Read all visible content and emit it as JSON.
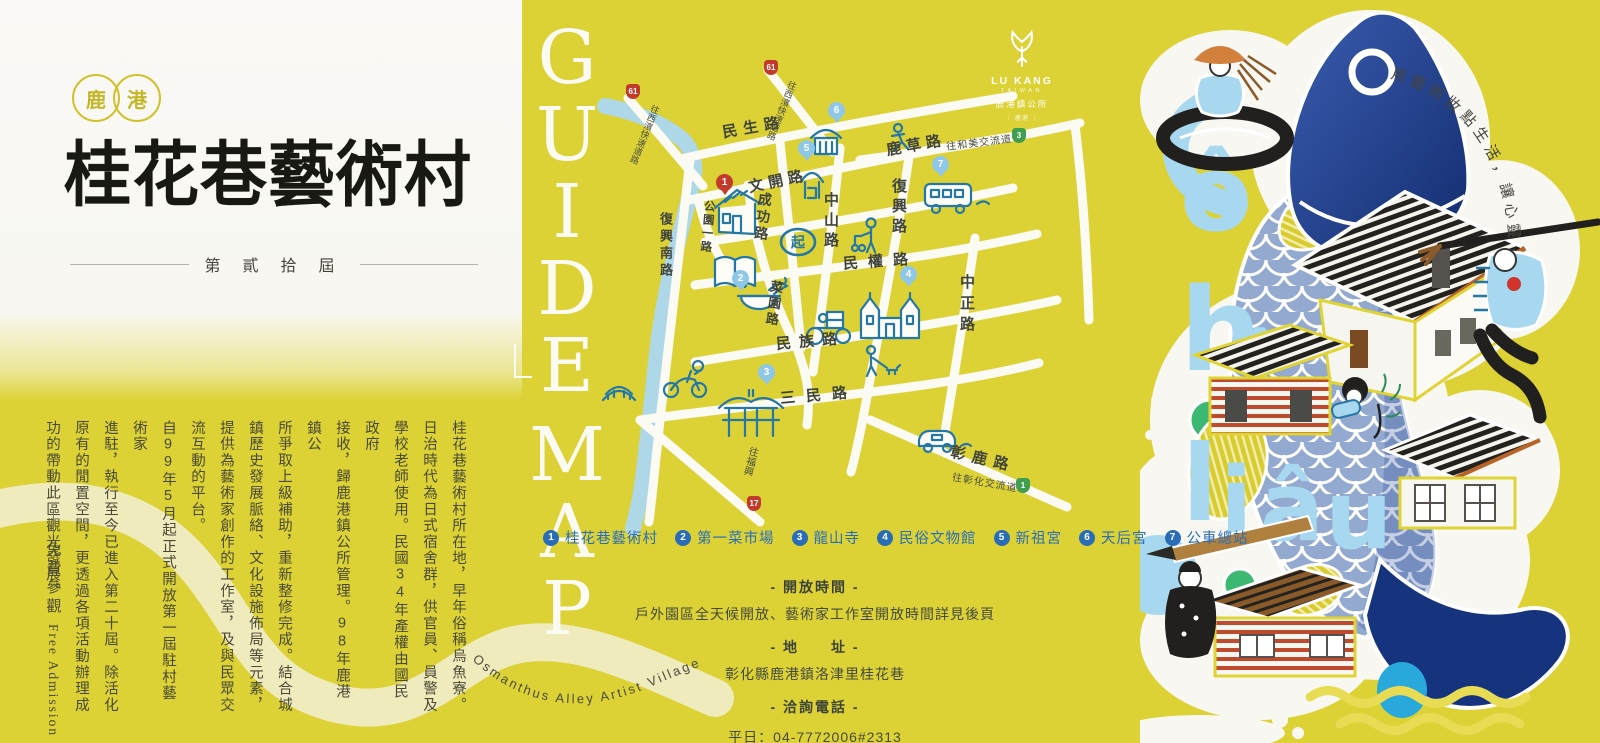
{
  "colors": {
    "bg_yellow": "#dcd235",
    "panel_white": "#f8f7f2",
    "ink_black": "#191914",
    "text_olive": "#4a4936",
    "map_doodle_blue": "#2577a6",
    "legend_blue": "#2a6db7",
    "river_blue": "#aed7e8",
    "fish_navy": "#16337e",
    "light_blue": "#a8d8f0",
    "tree_green": "#3cb873",
    "house_red": "#bf4a2e",
    "pin_red": "#c23a2b",
    "cream_ribbon": "#f0ebbc"
  },
  "left_panel": {
    "badge_chars": [
      "鹿",
      "港"
    ],
    "title": "桂花巷藝術村",
    "edition": "第 貳 拾 屆",
    "description_columns": [
      "桂花巷藝術村所在地，早年俗稱烏魚寮。",
      "日治時代為日式宿舍群，供官員、員警及",
      "學校老師使用。民國34年產權由國民政府",
      "接收，歸鹿港鎮公所管理。98年鹿港鎮公",
      "所爭取上級補助，重新整修完成。結合城",
      "鎮歷史發展脈絡、文化設施佈局等元素，",
      "提供為藝術家創作的工作室，及與民眾交",
      "流互動的平台。",
      "自99年5月起正式開放第一屆駐村藝術家",
      "進駐，執行至今已進入第二十屆。除活化",
      "原有的閒置空間，更透過各項活動辦理成",
      "功的帶動此區觀光發展。"
    ],
    "free_admission_zh": "免費參觀",
    "free_admission_en": "Free Admission"
  },
  "center_panel": {
    "guide_map_letters": [
      "G",
      "U",
      "I",
      "D",
      "E",
      "M",
      "A",
      "P"
    ],
    "logo": {
      "line1": "LU KANG",
      "line2": "TAIWAN",
      "line3": "鹿港鎮公所",
      "line4": "｜ 鹿港 ｜"
    },
    "map": {
      "street_labels": [
        "民生路",
        "文開路",
        "中山路",
        "復興路",
        "鹿草路",
        "中正路",
        "民權路",
        "民族路",
        "菜園路",
        "成功路",
        "公園一路",
        "復興南路",
        "三民路",
        "彰鹿路"
      ],
      "directions": [
        {
          "label": "往西濱快速道路",
          "shield": "61"
        },
        {
          "label": "往西濱快速道路",
          "shield": "61"
        },
        {
          "label": "往和美交流道",
          "shield": "3"
        },
        {
          "label": "往彰化交流道",
          "shield": "1"
        },
        {
          "label": "往福興",
          "shield": "17"
        }
      ],
      "start_marker": "起"
    },
    "legend": [
      {
        "num": "1",
        "label": "桂花巷藝術村"
      },
      {
        "num": "2",
        "label": "第一菜市場"
      },
      {
        "num": "3",
        "label": "龍山寺"
      },
      {
        "num": "4",
        "label": "民俗文物館"
      },
      {
        "num": "5",
        "label": "新祖宮"
      },
      {
        "num": "6",
        "label": "天后宮"
      },
      {
        "num": "7",
        "label": "公車總站"
      }
    ],
    "info_sections": {
      "hours_title": "- 開放時間 -",
      "hours_line": "戶外園區全天候開放、藝術家工作室開放時間詳見後頁",
      "address_title": "- 地　　址 -",
      "address_line": "彰化縣鹿港鎮洛津里桂花巷",
      "phone_title": "- 洽詢電話 -",
      "phone_line1": "平日：04-7772006#2313",
      "phone_line2": "假日：請聯繫各藝術家"
    },
    "curved_caption": "Osmanthus Alley Artist Village"
  },
  "right_panel": {
    "slogan": "用藝術妝點生活，讓心靈富足。",
    "word_letters": [
      "ô",
      "h",
      "î",
      "l",
      "i",
      "â",
      "u"
    ]
  }
}
